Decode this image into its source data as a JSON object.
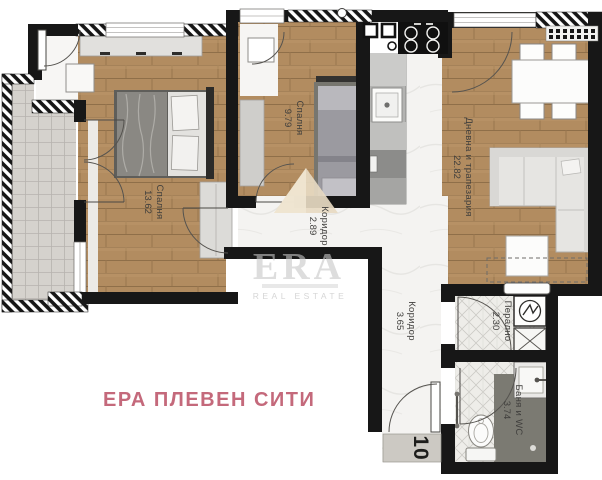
{
  "branding": {
    "project_name": "ЕРА ПЛЕВЕН СИТИ",
    "watermark_text": "ERA",
    "watermark_subtext": "REAL ESTATE",
    "accent_color": "#c4697b"
  },
  "apartment": {
    "unit_number": "10"
  },
  "rooms": [
    {
      "id": "bedroom-1",
      "label": "Спалня",
      "area": "13.62"
    },
    {
      "id": "bedroom-2",
      "label": "Спалня",
      "area": "9.79"
    },
    {
      "id": "living-dining",
      "label": "Дневна и трапезария",
      "area": "22.82"
    },
    {
      "id": "corridor-1",
      "label": "Коридор",
      "area": "2.89"
    },
    {
      "id": "corridor-2",
      "label": "Коридор",
      "area": "3.65"
    },
    {
      "id": "laundry",
      "label": "Перално",
      "area": "2.30"
    },
    {
      "id": "bathroom",
      "label": "Баня и WC",
      "area": "3.74"
    }
  ],
  "fixtures": [
    "double-bed-icon",
    "single-bed-icon",
    "wardrobe-icon",
    "dining-table-icon",
    "chair-icon",
    "corner-sofa-icon",
    "coffee-table-icon",
    "kitchen-counter-icon",
    "kitchen-sink-icon",
    "stove-icon",
    "washing-machine-icon",
    "boiler-icon",
    "toilet-icon",
    "bathroom-sink-icon",
    "shower-icon",
    "door-swing-icon",
    "entrance-mat-icon",
    "balcony-icon",
    "vent-duct-icon"
  ],
  "colors": {
    "wall": "#171717",
    "wood_floor": "#b28c60",
    "balcony_tile": "#d5d2cd",
    "marble_floor": "#f4f3f1",
    "bath_tile": "#eeede9",
    "shower_zone": "#7b7a72",
    "label_text": "#3f3e3c",
    "accent_pink": "#c4697b",
    "watermark_gray": "#c7c7c7"
  }
}
